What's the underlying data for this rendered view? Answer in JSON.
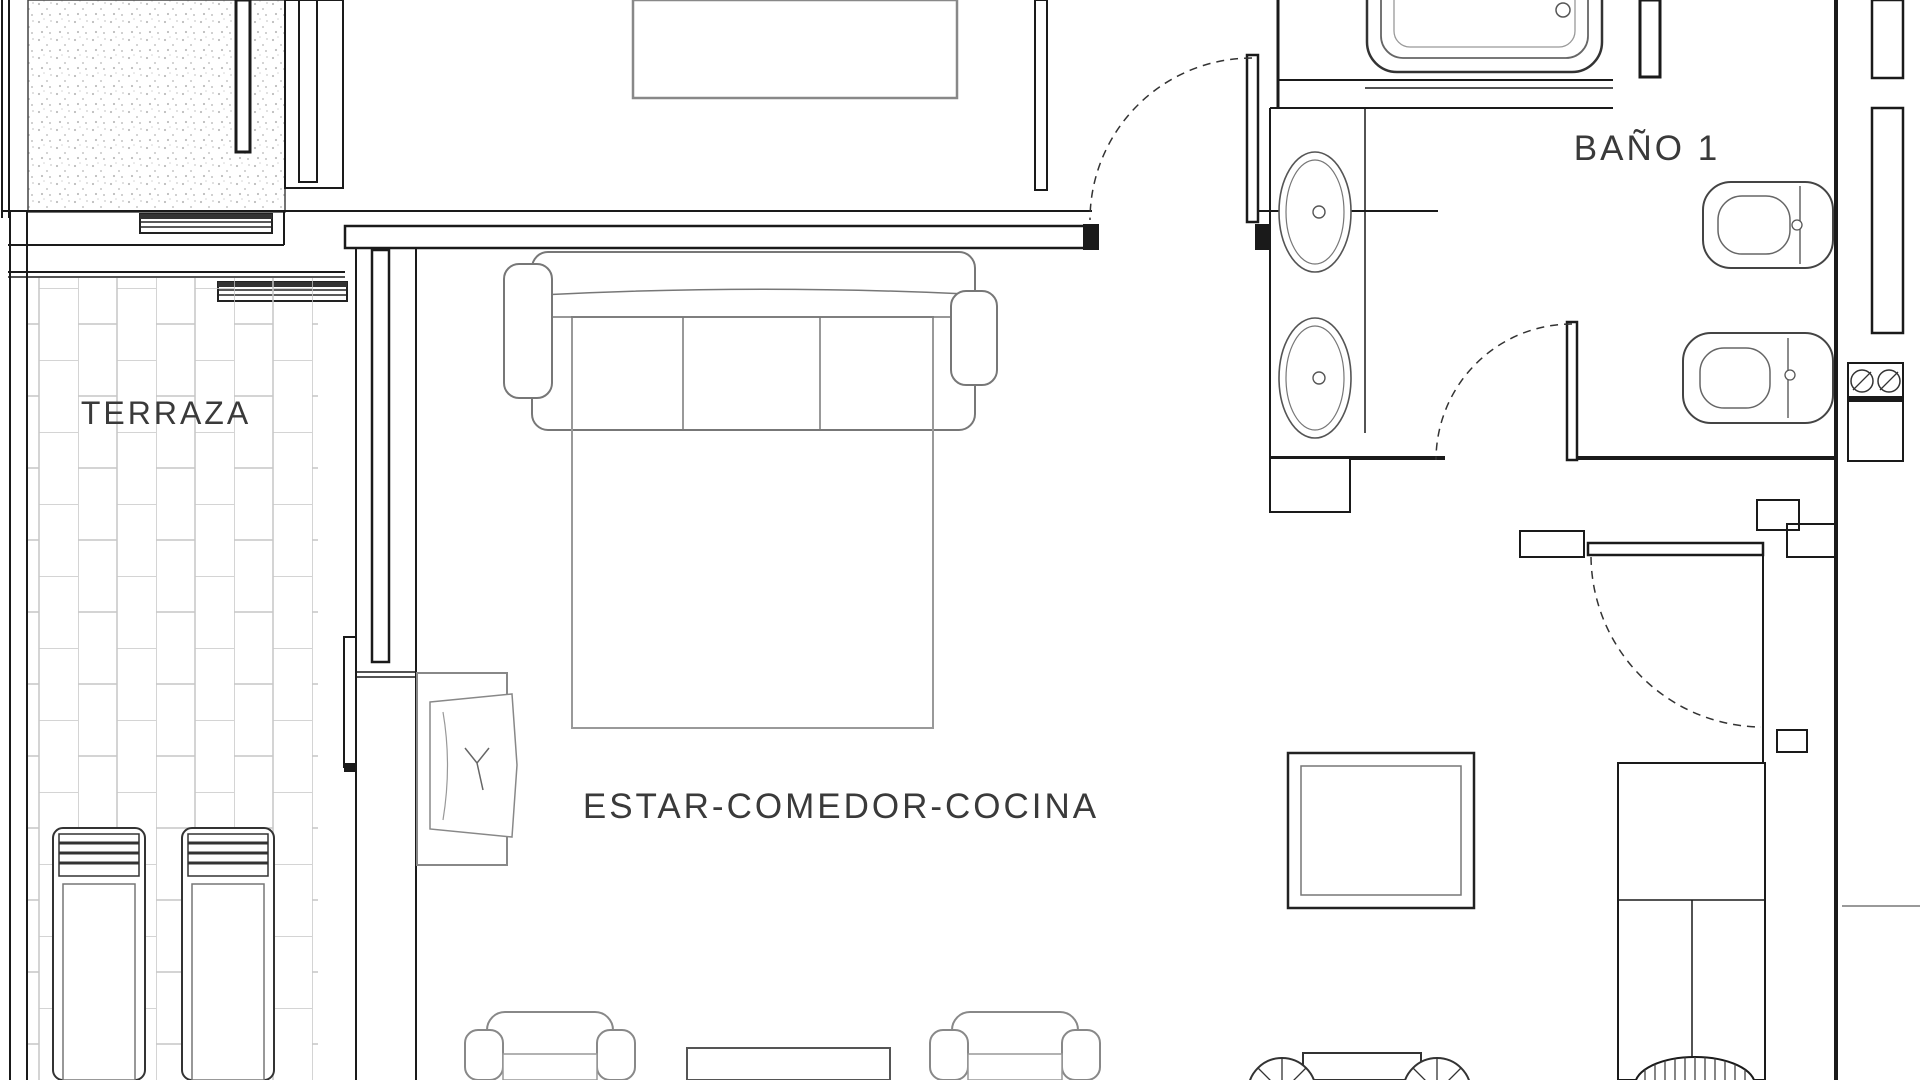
{
  "document": {
    "type": "architectural-floor-plan",
    "background": "#ffffff"
  },
  "rooms": {
    "terrace": {
      "label": "TERRAZA"
    },
    "living": {
      "label": "ESTAR-COMEDOR-COCINA"
    },
    "bath1": {
      "label": "BAÑO 1"
    }
  },
  "colors": {
    "wall": "#1a1a1a",
    "fixture_outline": "#4a4a4a",
    "furniture_gray": "#888888",
    "light_gray": "#b9b9b9",
    "label_text": "#3a3a3a",
    "tile_line": "#c6c6c6",
    "background": "#ffffff"
  },
  "symbols": [
    "bathtub",
    "washbasin",
    "toilet",
    "bidet",
    "door-swing",
    "sliding-door",
    "sofa",
    "rug",
    "tv-unit",
    "armchair",
    "coffee-table",
    "dining-table",
    "chair",
    "kitchen-counter",
    "kitchen-sink",
    "sun-lounger",
    "vent-grille",
    "hob-washer",
    "window",
    "stippled-shaft"
  ]
}
